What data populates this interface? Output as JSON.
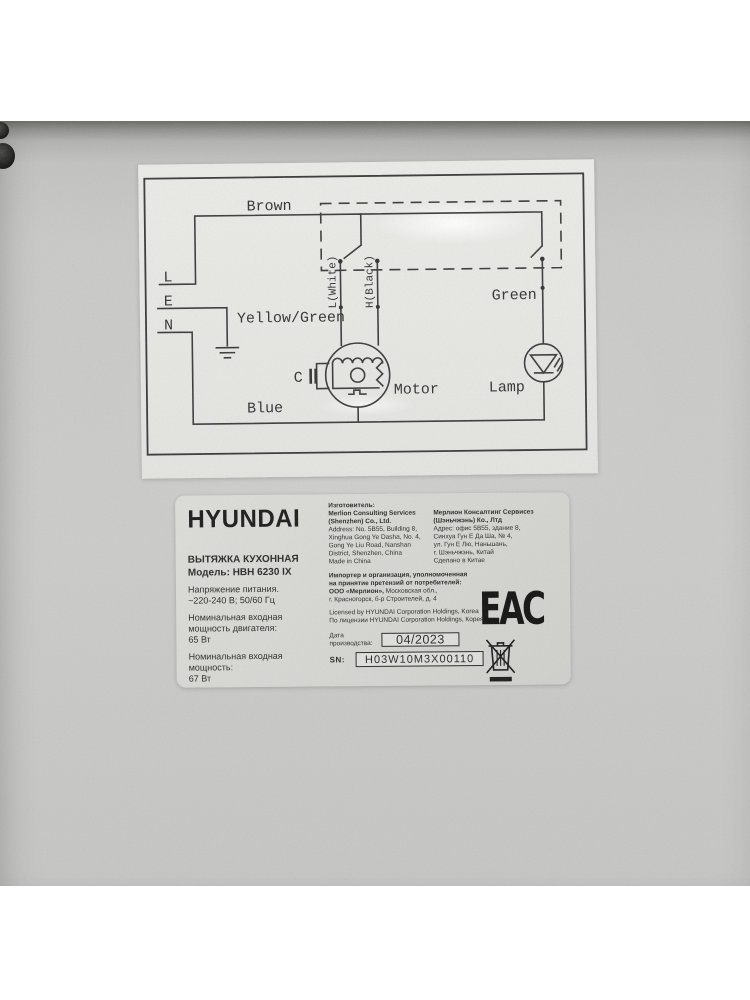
{
  "diagram": {
    "wire_labels": {
      "top": "Brown",
      "ground": "Yellow/Green",
      "bottom": "Blue",
      "lamp_wire": "Green"
    },
    "terminals": {
      "live": "L",
      "earth": "E",
      "neutral": "N"
    },
    "motor_wires": {
      "low": "L(White)",
      "high": "H(Black)"
    },
    "components": {
      "capacitor": "C",
      "motor": "Motor",
      "lamp": "Lamp"
    }
  },
  "label": {
    "brand": "HYUNDAI",
    "product_type": "ВЫТЯЖКА КУХОННАЯ",
    "model": "Модель: HBH 6230 IX",
    "specs": {
      "voltage_title": "Напряжение питания.",
      "voltage_value": "~220-240 В; 50/60 Гц",
      "motor_power_l1": "Номинальная входная",
      "motor_power_l2": "мощность двигателя:",
      "motor_power_value": "65 Вт",
      "input_power_l1": "Номинальная входная",
      "input_power_l2": "мощность:",
      "input_power_value": "67 Вт"
    },
    "manufacturer_en": {
      "title": "Изготовитель:",
      "name_l1": "Merlion Consulting Services",
      "name_l2": "(Shenzhen) Co., Ltd.",
      "addr_l1": "Address: No. 5B55, Building 8,",
      "addr_l2": "Xinghua Gong Ye Dasha, No. 4,",
      "addr_l3": "Gong Ye Liu Road, Nanshan",
      "addr_l4": "District, Shenzhen, China",
      "origin": "Made in China"
    },
    "manufacturer_ru": {
      "name_l1": "Мерлион Консалтинг Сервисез",
      "name_l2": "(Шэньчжэнь) Ко., Лтд",
      "addr_l1": "Адрес: офис 5В55, здание 8,",
      "addr_l2": "Синхуа Гун Е Да Ша, № 4,",
      "addr_l3": "ул. Гун Е Лю, Наньшань,",
      "addr_l4": "г. Шэньчжэнь, Китай",
      "origin": "Сделано в Китае"
    },
    "importer": {
      "l1": "Импортер и организация, уполномоченная",
      "l2": "на принятие претензий от потребителей:",
      "l3_bold": "ООО «Мерлион»,",
      "l3_rest": " Московская обл.,",
      "l4": "г. Красногорск, б-р Строителей, д. 4"
    },
    "license": {
      "en": "Licensed by HYUNDAI Corporation Holdings, Korea",
      "ru": "По лицензии HYUNDAI Corporation Holdings, Корея"
    },
    "production": {
      "label": "Дата производства:",
      "date": "04/2023"
    },
    "serial": {
      "label": "SN:",
      "value": "H03W10M3X00110"
    },
    "eac_mark": "ЕАС"
  }
}
